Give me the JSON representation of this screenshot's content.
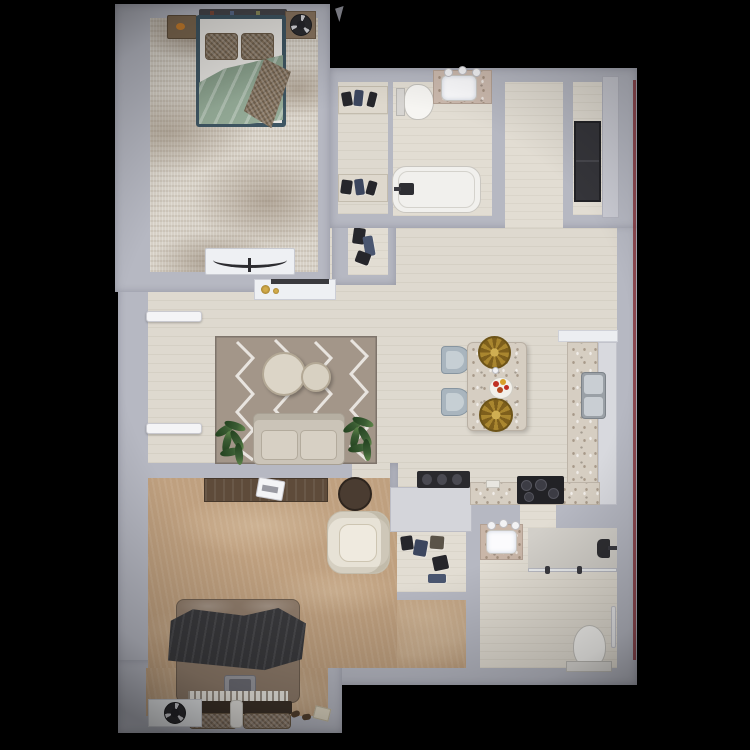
{
  "scene": {
    "type": "apartment-floor-plan-render",
    "view": "top-down 3d render",
    "visible_text": "none",
    "background_color": "#000000"
  },
  "colors": {
    "wall": "#b6b8c2",
    "floor_wood": "#ded9cf",
    "floor_bath": "#e2ddd3",
    "rug1": "#d7d1c7",
    "rug2": "#bfa07f",
    "rug_living": "#a39689",
    "terrazzo": "#d6cec2",
    "sofa": "#cbc4b8",
    "duvet_green": "#97ae9a",
    "blanket_dark": "#3a3a3d",
    "mattress2": "#8f7c6b",
    "walnut": "#5e4b3a",
    "wood_dark": "#3d3229",
    "gold": "#a9862f",
    "chair_blue": "#a9b5be",
    "plant": "#3a5c33",
    "fixture_white": "#f3f2ef",
    "appliance": "#2a2a2e",
    "accent_red": "#7c1d22"
  },
  "rooms": [
    {
      "id": "bedroom-1",
      "position": "top-left",
      "floor": "distressed beige-brown rug",
      "furniture": [
        "double-bed-green-duvet",
        "textured-pillows",
        "nightstand-with-candle",
        "headboard-shelf",
        "ceiling-fan",
        "white-dresser"
      ]
    },
    {
      "id": "closet-top",
      "position": "top-center",
      "floor": "wood",
      "furniture": [
        "shoe-shelf-upper",
        "shoe-shelf-lower"
      ]
    },
    {
      "id": "bathroom-1",
      "position": "top-center",
      "floor": "light wood",
      "furniture": [
        "toilet",
        "vanity-sink",
        "bathtub"
      ]
    },
    {
      "id": "hall-nook",
      "position": "top-right",
      "floor": "light wood",
      "furniture": []
    },
    {
      "id": "wardrobe-niche",
      "position": "top-right",
      "floor": "light wood",
      "furniture": [
        "dark-wardrobe-cabinet",
        "sliding-panel"
      ]
    },
    {
      "id": "hallway",
      "position": "center-left",
      "floor": "wood",
      "furniture": [
        "wall-console-with-gold-decor",
        "hanging-clothes-closet",
        "radiator-upper",
        "radiator-lower"
      ]
    },
    {
      "id": "living-room",
      "position": "center",
      "floor": "wood",
      "furniture": [
        "zigzag-rug",
        "round-coffee-table-large",
        "round-coffee-table-small",
        "loveseat-sofa",
        "plant-left",
        "plant-right"
      ]
    },
    {
      "id": "dining-area",
      "position": "center-right",
      "floor": "wood",
      "furniture": [
        "terrazzo-dining-table",
        "gold-chair-north",
        "gold-chair-south",
        "blue-chair-upper",
        "blue-chair-lower",
        "fruit-plate"
      ]
    },
    {
      "id": "kitchen",
      "position": "right",
      "floor": "wood",
      "furniture": [
        "window-ledge",
        "right-counter-terrazzo",
        "double-sink",
        "bottom-counter-terrazzo",
        "stove-with-pots",
        "cutting-board",
        "peninsula-cabinet",
        "small-appliance-row"
      ]
    },
    {
      "id": "bedroom-2",
      "position": "bottom-left",
      "floor": "tan rug",
      "furniture": [
        "desk-walnut",
        "laptop",
        "round-side-table",
        "cream-armchair",
        "double-bed-dark-blanket",
        "bed-tray",
        "headboard-bench-pillows",
        "ceiling-fan-box",
        "slippers",
        "door-mat"
      ]
    },
    {
      "id": "closet-2",
      "position": "bottom-center",
      "floor": "light wood",
      "furniture": [
        "folded-clothes-shelves"
      ]
    },
    {
      "id": "bathroom-2",
      "position": "bottom-right",
      "floor": "light wood",
      "furniture": [
        "vanity-sink",
        "walk-in-shower",
        "shower-head",
        "glass-partition",
        "toilet",
        "towel-bar"
      ]
    }
  ]
}
